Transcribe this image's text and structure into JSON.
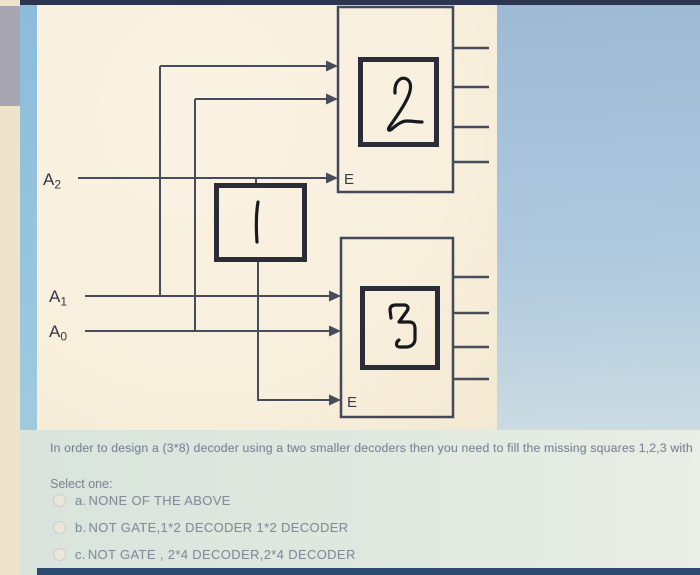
{
  "colors": {
    "top_bar": "#2b3550",
    "bottom_bar": "#2d4a70",
    "diagram_panel_bg": "#f8efdd",
    "question_panel_bg": "#dde7df",
    "side_strip_blue": "#8cbcdc",
    "left_strip_cream": "#efe3cb",
    "gray_block": "#a9a6b4",
    "wire_color": "#474c5c",
    "thick_box_color": "#2a2d37",
    "text_color": "#7e8795"
  },
  "diagram": {
    "inputs": [
      {
        "label": "A",
        "sub": "2"
      },
      {
        "label": "A",
        "sub": "1"
      },
      {
        "label": "A",
        "sub": "0"
      }
    ],
    "decoders": [
      {
        "enable_label": "E",
        "digit": "2",
        "output_count": 4
      },
      {
        "enable_label": "E",
        "digit": "3",
        "output_count": 4
      }
    ],
    "gate_box_digit": "1"
  },
  "question": {
    "text": "In order to design a (3*8) decoder using a two smaller decoders then you need to fill the missing squares 1,2,3 with",
    "select_label": "Select one:",
    "options": [
      {
        "letter": "a.",
        "text": "NONE OF THE ABOVE"
      },
      {
        "letter": "b.",
        "text": "NOT GATE,1*2 DECODER 1*2 DECODER"
      },
      {
        "letter": "c.",
        "text": "NOT GATE , 2*4 DECODER,2*4 DECODER"
      }
    ]
  }
}
